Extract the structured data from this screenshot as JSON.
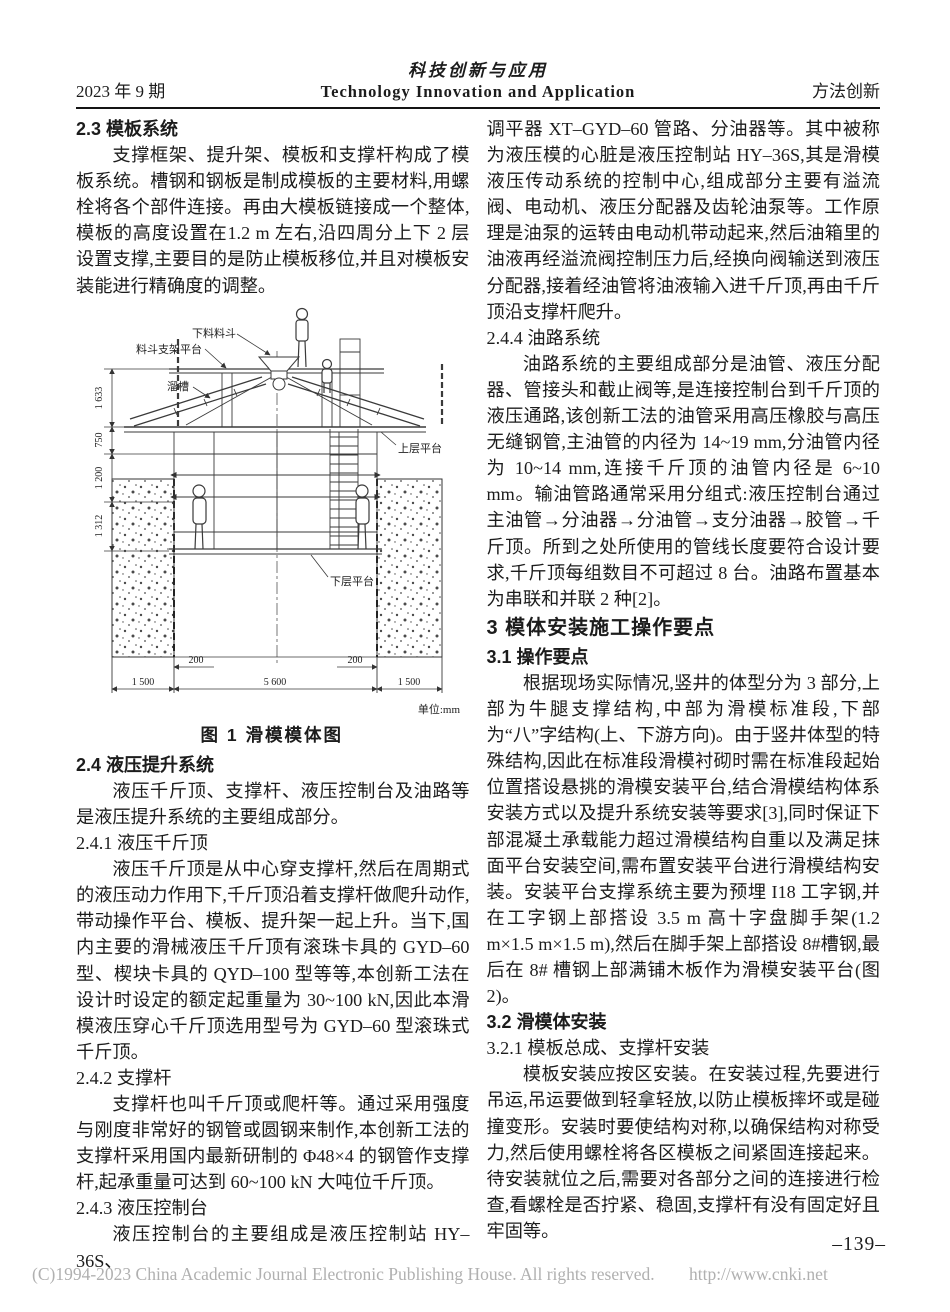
{
  "header": {
    "issue": "2023 年 9 期",
    "journal_cn": "科技创新与应用",
    "journal_en": "Technology Innovation and Application",
    "column_name": "方法创新"
  },
  "left_blocks": [
    {
      "type": "h2",
      "text": "2.3  模板系统"
    },
    {
      "type": "p",
      "text": "支撑框架、提升架、模板和支撑杆构成了模板系统。槽钢和钢板是制成模板的主要材料,用螺栓将各个部件连接。再由大模板链接成一个整体,模板的高度设置在1.2 m 左右,沿四周分上下 2 层设置支撑,主要目的是防止模板移位,并且对模板安装能进行精确度的调整。"
    },
    {
      "type": "h2",
      "text": "2.4  液压提升系统"
    },
    {
      "type": "p",
      "text": "液压千斤顶、支撑杆、液压控制台及油路等是液压提升系统的主要组成部分。"
    },
    {
      "type": "h3",
      "text": "2.4.1  液压千斤顶"
    },
    {
      "type": "p",
      "text": "液压千斤顶是从中心穿支撑杆,然后在周期式的液压动力作用下,千斤顶沿着支撑杆做爬升动作,带动操作平台、模板、提升架一起上升。当下,国内主要的滑械液压千斤顶有滚珠卡具的 GYD–60 型、楔块卡具的 QYD–100 型等等,本创新工法在设计时设定的额定起重量为 30~100 kN,因此本滑模液压穿心千斤顶选用型号为 GYD–60 型滚珠式千斤顶。"
    },
    {
      "type": "h3",
      "text": "2.4.2  支撑杆"
    },
    {
      "type": "p",
      "text": "支撑杆也叫千斤顶或爬杆等。通过采用强度与刚度非常好的钢管或圆钢来制作,本创新工法的支撑杆采用国内最新研制的 Φ48×4 的钢管作支撑杆,起承重量可达到 60~100 kN 大吨位千斤顶。"
    },
    {
      "type": "h3",
      "text": "2.4.3  液压控制台"
    },
    {
      "type": "p",
      "text": "液压控制台的主要组成是液压控制站 HY–36S、"
    }
  ],
  "right_blocks": [
    {
      "type": "p-cont",
      "text": "调平器 XT–GYD–60 管路、分油器等。其中被称为液压模的心脏是液压控制站 HY–36S,其是滑模液压传动系统的控制中心,组成部分主要有溢流阀、电动机、液压分配器及齿轮油泵等。工作原理是油泵的运转由电动机带动起来,然后油箱里的油液再经溢流阀控制压力后,经换向阀输送到液压分配器,接着经油管将油液输入进千斤顶,再由千斤顶沿支撑杆爬升。"
    },
    {
      "type": "h3",
      "text": "2.4.4  油路系统"
    },
    {
      "type": "p",
      "text": "油路系统的主要组成部分是油管、液压分配器、管接头和截止阀等,是连接控制台到千斤顶的液压通路,该创新工法的油管采用高压橡胶与高压无缝钢管,主油管的内径为 14~19 mm,分油管内径为 10~14 mm,连接千斤顶的油管内径是 6~10 mm。输油管路通常采用分组式:液压控制台通过主油管→分油器→分油管→支分油器→胶管→千斤顶。所到之处所使用的管线长度要符合设计要求,千斤顶每组数目不可超过 8 台。油路布置基本为串联和并联 2 种[2]。"
    },
    {
      "type": "h1",
      "text": "3  模体安装施工操作要点"
    },
    {
      "type": "h2",
      "text": "3.1  操作要点"
    },
    {
      "type": "p",
      "text": "根据现场实际情况,竖井的体型分为 3 部分,上部为牛腿支撑结构,中部为滑模标准段,下部为“八”字结构(上、下游方向)。由于竖井体型的特殊结构,因此在标准段滑模衬砌时需在标准段起始位置搭设悬挑的滑模安装平台,结合滑模结构体系安装方式以及提升系统安装等要求[3],同时保证下部混凝土承载能力超过滑模结构自重以及满足抹面平台安装空间,需布置安装平台进行滑模结构安装。安装平台支撑系统主要为预埋 I18 工字钢,并在工字钢上部搭设 3.5 m 高十字盘脚手架(1.2 m×1.5 m×1.5 m),然后在脚手架上部搭设 8#槽钢,最后在 8# 槽钢上部满铺木板作为滑模安装平台(图 2)。"
    },
    {
      "type": "h2",
      "text": "3.2  滑模体安装"
    },
    {
      "type": "h3",
      "text": "3.2.1  模板总成、支撑杆安装"
    },
    {
      "type": "p",
      "text": "模板安装应按区安装。在安装过程,先要进行吊运,吊运要做到轻拿轻放,以防止模板摔坏或是碰撞变形。安装时要使结构对称,以确保结构对称受力,然后使用螺栓将各区模板之间紧固连接起来。待安装就位之后,需要对各部分之间的连接进行检查,看螺栓是否拧紧、稳固,支撑杆有没有固定好且牢固等。"
    }
  ],
  "figure1": {
    "caption": "图 1  滑模模体图",
    "unit_note": "单位:mm",
    "labels": {
      "hopper": "下料料斗",
      "hopper_platform": "料斗支架平台",
      "chute": "溜槽",
      "upper_platform": "上层平台",
      "lower_platform": "下层平台"
    },
    "dims": {
      "d1633": "1 633",
      "d750": "750",
      "d1200": "1 200",
      "d1312": "1 312",
      "d200L": "200",
      "d200R": "200",
      "d1500L": "1 500",
      "d5600": "5 600",
      "d1500R": "1 500"
    }
  },
  "footer": {
    "page_number": "–139–",
    "copyright": "(C)1994-2023 China Academic Journal Electronic Publishing House. All rights reserved.",
    "url": "http://www.cnki.net"
  }
}
